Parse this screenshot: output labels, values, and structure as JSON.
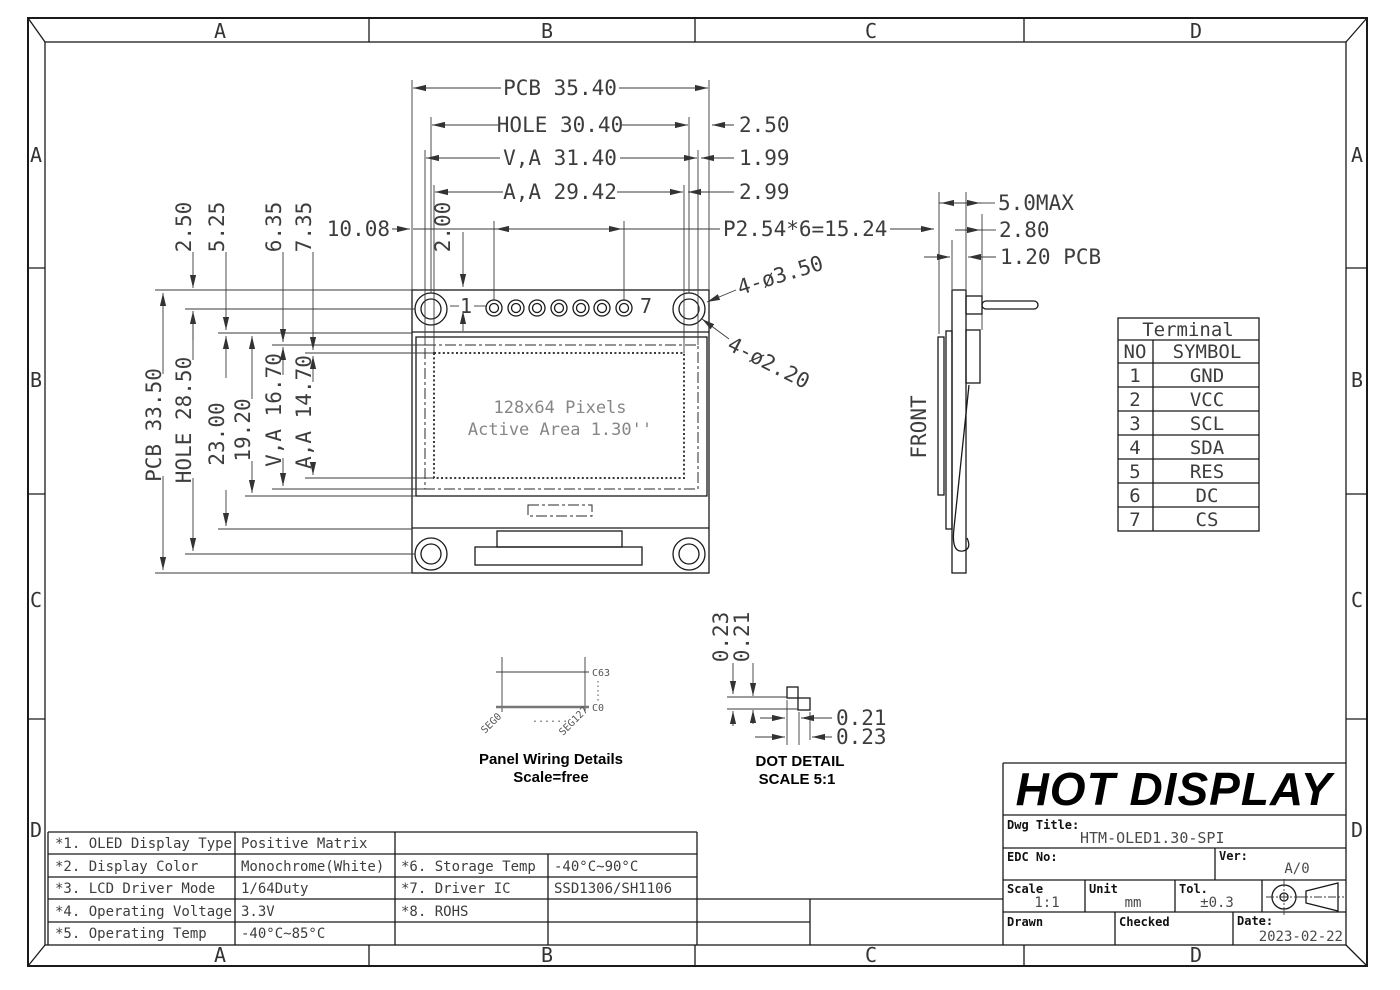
{
  "sheet": {
    "zones": [
      "A",
      "B",
      "C",
      "D"
    ]
  },
  "front_view": {
    "pin_first_label": "1",
    "pin_last_label": "7",
    "display_line1": "128x64 Pixels",
    "display_line2": "Active Area 1.30''"
  },
  "dims": {
    "pcb_w": "PCB 35.40",
    "hole_w": "HOLE 30.40",
    "va_w": "V,A 31.40",
    "aa_w": "A,A 29.42",
    "off_2_50_r": "2.50",
    "off_1_99": "1.99",
    "off_2_99": "2.99",
    "pitch": "P2.54*6=15.24",
    "off_10_08": "10.08",
    "off_2_00": "2.00",
    "off_2_50_l": "2.50",
    "off_5_25": "5.25",
    "off_6_35": "6.35",
    "off_7_35": "7.35",
    "pcb_h": "PCB 33.50",
    "hole_h": "HOLE 28.50",
    "h_23": "23.00",
    "h_19_20": "19.20",
    "va_h": "V,A 16.70",
    "aa_h": "A,A 14.70",
    "holes_outer": "4-ø3.50",
    "holes_inner": "4-ø2.20",
    "side_max": "5.0MAX",
    "side_2_80": "2.80",
    "side_pcb": "1.20 PCB"
  },
  "side_view": {
    "front_label": "FRONT"
  },
  "panel_wiring": {
    "c63": "C63",
    "c0": "C0",
    "seg0": "SEG0",
    "seg127": "SEG127",
    "dots_h": "......",
    "caption1": "Panel Wiring Details",
    "caption2": "Scale=free"
  },
  "dot_detail": {
    "v_0_23": "0.23",
    "v_0_21": "0.21",
    "h_0_21": "0.21",
    "h_0_23": "0.23",
    "caption1": "DOT DETAIL",
    "caption2": "SCALE 5:1"
  },
  "terminal_table": {
    "title": "Terminal",
    "col_no": "NO",
    "col_symbol": "SYMBOL",
    "rows": [
      {
        "no": "1",
        "symbol": "GND"
      },
      {
        "no": "2",
        "symbol": "VCC"
      },
      {
        "no": "3",
        "symbol": "SCL"
      },
      {
        "no": "4",
        "symbol": "SDA"
      },
      {
        "no": "5",
        "symbol": "RES"
      },
      {
        "no": "6",
        "symbol": "DC"
      },
      {
        "no": "7",
        "symbol": "CS"
      }
    ]
  },
  "spec_table": {
    "rows": [
      {
        "k1": "*1. OLED Display Type",
        "v1": "Positive Matrix",
        "k2": "",
        "v2": ""
      },
      {
        "k1": "*2. Display Color",
        "v1": "Monochrome(White)",
        "k2": "*6. Storage Temp",
        "v2": "-40°C~90°C"
      },
      {
        "k1": "*3. LCD Driver Mode",
        "v1": "1/64Duty",
        "k2": "*7. Driver IC",
        "v2": "SSD1306/SH1106"
      },
      {
        "k1": "*4. Operating Voltage",
        "v1": "3.3V",
        "k2": "*8. ROHS",
        "v2": ""
      },
      {
        "k1": "*5. Operating Temp",
        "v1": "-40°C~85°C",
        "k2": "",
        "v2": ""
      }
    ]
  },
  "title_block": {
    "company": "HOT DISPLAY",
    "dwg_title_label": "Dwg Title:",
    "dwg_title": "HTM-OLED1.30-SPI",
    "edc_label": "EDC No:",
    "ver_label": "Ver:",
    "ver": "A/0",
    "scale_label": "Scale",
    "scale": "1:1",
    "unit_label": "Unit",
    "unit": "mm",
    "tol_label": "Tol.",
    "tol": "±0.3",
    "drawn_label": "Drawn",
    "checked_label": "Checked",
    "date_label": "Date:",
    "date": "2023-02-22"
  }
}
